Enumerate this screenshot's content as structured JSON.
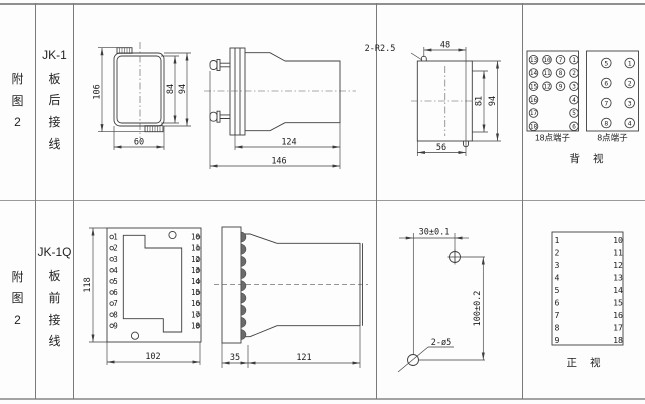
{
  "rows": [
    {
      "fig_label": "附图2",
      "model": "JK-1",
      "wiring": "板后接线"
    },
    {
      "fig_label": "附图2",
      "model": "JK-1Q",
      "wiring": "板前接线"
    }
  ],
  "rear_outline": {
    "overall_height": "106",
    "inner_height": "84",
    "outer_height": "94",
    "width": "60"
  },
  "rear_side": {
    "body_length": "124",
    "total_length": "146"
  },
  "cutout": {
    "slot_note": "2-R2.5",
    "slot_span": "48",
    "inner_height": "81",
    "outer_height": "94",
    "width": "56"
  },
  "rear_terminals": {
    "t18_label": "18点端子",
    "t8_label": "8点端子",
    "view_label": "背 视",
    "t18": [
      [
        "13",
        "10",
        "7",
        "1"
      ],
      [
        "14",
        "11",
        "8",
        "2"
      ],
      [
        "15",
        "12",
        "9",
        "3"
      ],
      [
        "16",
        "",
        "",
        "4"
      ],
      [
        "17",
        "",
        "",
        "5"
      ],
      [
        "18",
        "",
        "",
        "6"
      ]
    ],
    "t8": [
      [
        "5",
        "1"
      ],
      [
        "6",
        "2"
      ],
      [
        "7",
        "3"
      ],
      [
        "8",
        "4"
      ]
    ]
  },
  "front_outline": {
    "height": "118",
    "width": "102",
    "left": [
      "1",
      "2",
      "3",
      "4",
      "5",
      "6",
      "7",
      "8",
      "9"
    ],
    "right": [
      "10",
      "11",
      "12",
      "13",
      "14",
      "15",
      "16",
      "17",
      "18"
    ]
  },
  "front_side": {
    "panel_depth": "35",
    "body_length": "121"
  },
  "drill": {
    "h_span": "30±0.1",
    "v_span": "100±0.2",
    "hole_note": "2-ø5"
  },
  "front_terminals": {
    "left": [
      "1",
      "2",
      "3",
      "4",
      "5",
      "6",
      "7",
      "8",
      "9"
    ],
    "right": [
      "10",
      "11",
      "12",
      "13",
      "14",
      "15",
      "16",
      "17",
      "18"
    ],
    "view_label": "正 视"
  }
}
